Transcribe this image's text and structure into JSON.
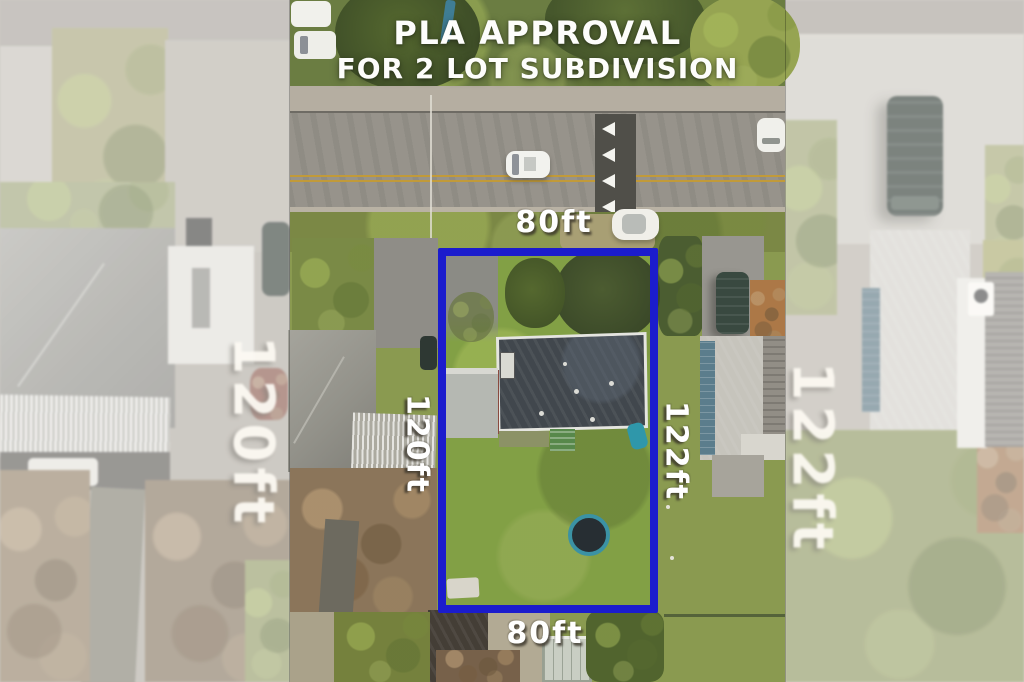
{
  "overlay": {
    "title_line1": "PLA APPROVAL",
    "title_line2": "FOR 2 LOT SUBDIVISION",
    "front_width_label": "80ft",
    "left_depth_label": "120ft",
    "right_depth_label": "122ft",
    "rear_width_label": "80ft"
  },
  "background_panels": {
    "left_label": "120ft",
    "right_label": "122ft"
  },
  "colors": {
    "boundary_blue": "#1b1ccd",
    "label_text": "#ffffff",
    "road_gray": "#97938b",
    "lot_grass": "#82a045",
    "house_roof": "#41474d",
    "trampoline_rim": "#3b92a4"
  }
}
